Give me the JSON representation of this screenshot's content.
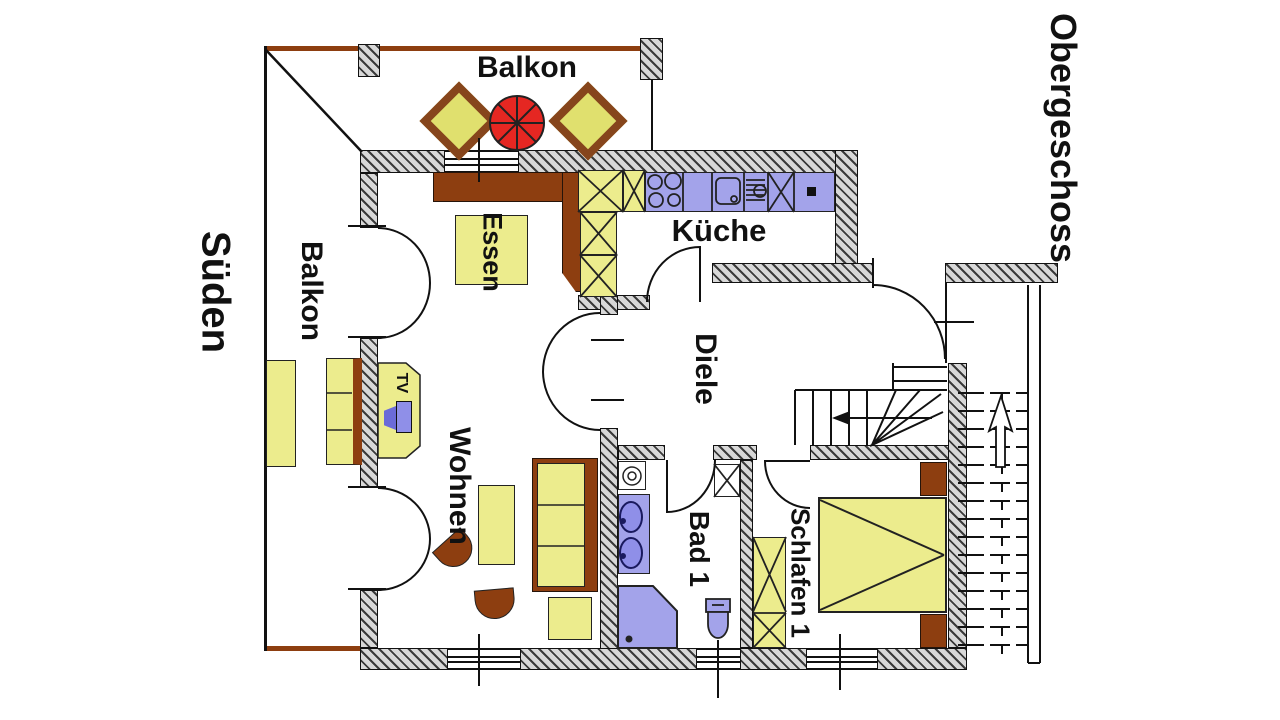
{
  "plan": {
    "floor_label": "Obergeschoss",
    "orientation_label": "Süden",
    "rooms": {
      "balcony_top": "Balkon",
      "balcony_left": "Balkon",
      "dining": "Essen",
      "kitchen": "Küche",
      "hall": "Diele",
      "living": "Wohnen",
      "bath": "Bad 1",
      "bedroom": "Schlafen 1"
    },
    "furniture_labels": {
      "tv": "TV"
    },
    "colors": {
      "wall_fill": "#d8d8d8",
      "hatch_line": "#3a3a3a",
      "furniture_yellow": "#ecec8d",
      "wood_brown": "#8d3e10",
      "fixture_blue": "#a3a3ea",
      "parasol_red": "#e52722",
      "line": "#111111",
      "background": "#ffffff"
    }
  }
}
